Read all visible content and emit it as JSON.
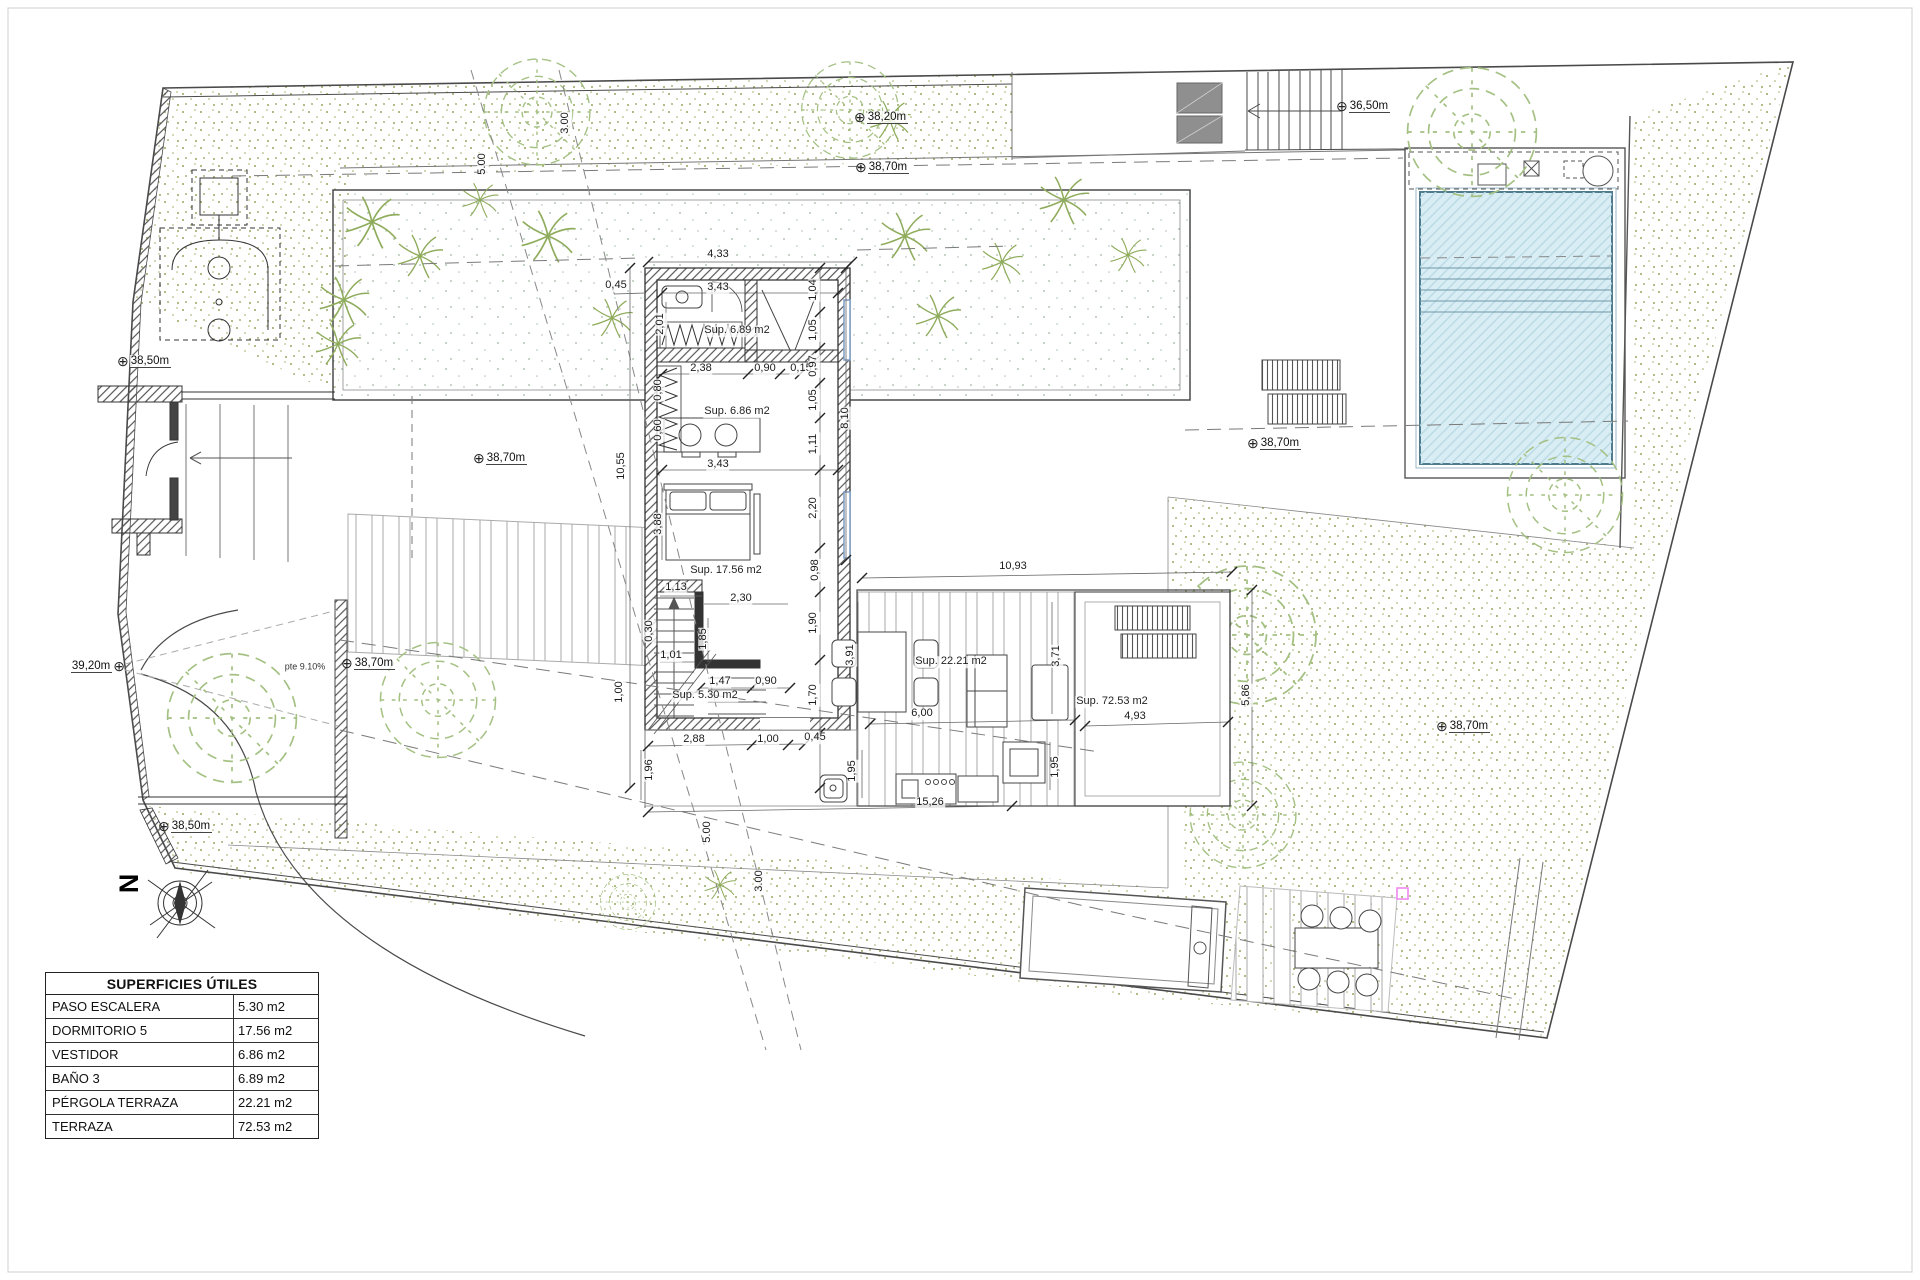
{
  "surface_table": {
    "title": "SUPERFICIES ÚTILES",
    "rows": [
      {
        "name": "PASO ESCALERA",
        "area": "5.30 m2"
      },
      {
        "name": "DORMITORIO 5",
        "area": "17.56 m2"
      },
      {
        "name": "VESTIDOR",
        "area": "6.86 m2"
      },
      {
        "name": "BAÑO 3",
        "area": "6.89 m2"
      },
      {
        "name": "PÉRGOLA TERRAZA",
        "area": "22.21 m2"
      },
      {
        "name": "TERRAZA",
        "area": "72.53 m2"
      }
    ]
  },
  "compass": {
    "north_label": "N"
  },
  "icons": {
    "elevation": "⊕"
  },
  "colors": {
    "plan_line": "#4a4a4a",
    "green_dot": "#97a75f",
    "pool_fill": "#d9edf4",
    "pool_line": "#4f7c8c",
    "accent_magenta": "#ee82ee",
    "panel_gray": "#8f8f8f"
  },
  "room_labels": [
    {
      "t": "Sup. 6.89 m2",
      "x": 737,
      "y": 331
    },
    {
      "t": "Sup. 6.86 m2",
      "x": 737,
      "y": 412
    },
    {
      "t": "Sup. 17.56 m2",
      "x": 726,
      "y": 571
    },
    {
      "t": "Sup. 5.30 m2",
      "x": 705,
      "y": 696
    },
    {
      "t": "Sup. 22.21 m2",
      "x": 951,
      "y": 662
    },
    {
      "t": "Sup. 72.53 m2",
      "x": 1112,
      "y": 702
    }
  ],
  "dimension_labels": [
    {
      "t": "4,33",
      "x": 718,
      "y": 255
    },
    {
      "t": "0,45",
      "x": 616,
      "y": 286
    },
    {
      "t": "3,43",
      "x": 718,
      "y": 288
    },
    {
      "t": "2,01",
      "x": 661,
      "y": 324,
      "r": 1
    },
    {
      "t": "2,38",
      "x": 701,
      "y": 369
    },
    {
      "t": "0,90",
      "x": 765,
      "y": 369
    },
    {
      "t": "0,15",
      "x": 801,
      "y": 369
    },
    {
      "t": "0,80",
      "x": 659,
      "y": 390,
      "r": 1
    },
    {
      "t": "0,60",
      "x": 659,
      "y": 430,
      "r": 1
    },
    {
      "t": "3,43",
      "x": 718,
      "y": 465
    },
    {
      "t": "1,04",
      "x": 814,
      "y": 290,
      "r": 1
    },
    {
      "t": "1,05",
      "x": 814,
      "y": 330,
      "r": 1
    },
    {
      "t": "0,97",
      "x": 814,
      "y": 366,
      "r": 1
    },
    {
      "t": "1,05",
      "x": 814,
      "y": 400,
      "r": 1
    },
    {
      "t": "1,11",
      "x": 814,
      "y": 444,
      "r": 1
    },
    {
      "t": "8,10",
      "x": 846,
      "y": 418,
      "r": 1
    },
    {
      "t": "10,55",
      "x": 622,
      "y": 466,
      "r": 1
    },
    {
      "t": "3,88",
      "x": 659,
      "y": 524,
      "r": 1
    },
    {
      "t": "2,20",
      "x": 814,
      "y": 508,
      "r": 1
    },
    {
      "t": "0,98",
      "x": 816,
      "y": 570,
      "r": 1
    },
    {
      "t": "1,13",
      "x": 676,
      "y": 588
    },
    {
      "t": "2,30",
      "x": 741,
      "y": 599
    },
    {
      "t": "0,30",
      "x": 650,
      "y": 631,
      "r": 1
    },
    {
      "t": "1,85",
      "x": 704,
      "y": 639,
      "r": 1
    },
    {
      "t": "1,90",
      "x": 814,
      "y": 623,
      "r": 1
    },
    {
      "t": "1,01",
      "x": 671,
      "y": 656
    },
    {
      "t": "1,47",
      "x": 720,
      "y": 682
    },
    {
      "t": "0,90",
      "x": 766,
      "y": 682
    },
    {
      "t": "1,70",
      "x": 814,
      "y": 695,
      "r": 1
    },
    {
      "t": "1,00",
      "x": 620,
      "y": 692,
      "r": 1
    },
    {
      "t": "2,88",
      "x": 694,
      "y": 740
    },
    {
      "t": "1,00",
      "x": 768,
      "y": 740
    },
    {
      "t": "0,45",
      "x": 815,
      "y": 738
    },
    {
      "t": "1,96",
      "x": 650,
      "y": 770,
      "r": 1
    },
    {
      "t": "1,95",
      "x": 853,
      "y": 771,
      "r": 1
    },
    {
      "t": "15,26",
      "x": 930,
      "y": 803
    },
    {
      "t": "6,00",
      "x": 922,
      "y": 714
    },
    {
      "t": "10,93",
      "x": 1013,
      "y": 567
    },
    {
      "t": "3,91",
      "x": 851,
      "y": 655,
      "r": 1
    },
    {
      "t": "3,71",
      "x": 1057,
      "y": 656,
      "r": 1
    },
    {
      "t": "1,95",
      "x": 1056,
      "y": 767,
      "r": 1
    },
    {
      "t": "4,93",
      "x": 1135,
      "y": 717
    },
    {
      "t": "5,86",
      "x": 1247,
      "y": 695,
      "r": 1
    },
    {
      "t": "5.00",
      "x": 483,
      "y": 164,
      "r": 1
    },
    {
      "t": "3.00",
      "x": 566,
      "y": 123,
      "r": 1
    },
    {
      "t": "5.00",
      "x": 708,
      "y": 832,
      "r": 1
    },
    {
      "t": "3.00",
      "x": 760,
      "y": 881,
      "r": 1
    }
  ],
  "notes": [
    {
      "t": "pte 9.10%",
      "x": 305,
      "y": 667
    }
  ],
  "elevation_markers": [
    {
      "label": "38,20m",
      "x": 862,
      "y": 117
    },
    {
      "label": "38,70m",
      "x": 863,
      "y": 167
    },
    {
      "label": "36,50m",
      "x": 1344,
      "y": 106
    },
    {
      "label": "38,50m",
      "x": 125,
      "y": 361
    },
    {
      "label": "38,70m",
      "x": 481,
      "y": 458
    },
    {
      "label": "39,20m",
      "x": 117,
      "y": 666,
      "side": "left"
    },
    {
      "label": "38,70m",
      "x": 349,
      "y": 663
    },
    {
      "label": "38,50m",
      "x": 166,
      "y": 826
    },
    {
      "label": "38,70m",
      "x": 1255,
      "y": 443
    },
    {
      "label": "38,70m",
      "x": 1444,
      "y": 726
    }
  ]
}
